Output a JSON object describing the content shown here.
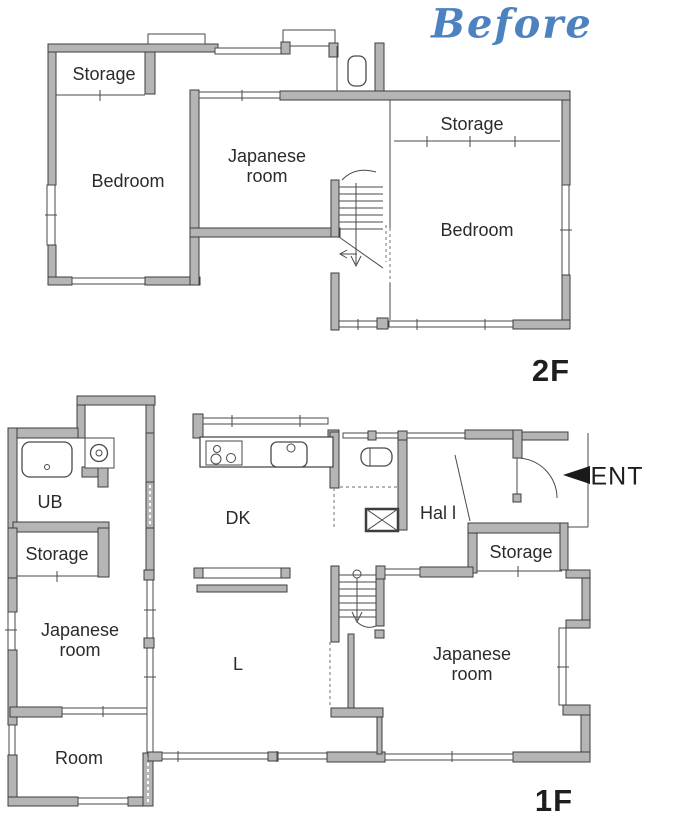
{
  "title": "Before",
  "colors": {
    "accent_blue": "#4d82c0",
    "wall_fill": "#b5b5b5",
    "wall_stroke": "#3d3d3d",
    "label_color": "#2b2b2b",
    "ent_arrow": "#1a1a1a"
  },
  "floor_2f": {
    "floor_label": "2F",
    "rooms": {
      "storage_left": "Storage",
      "bedroom_left": "Bedroom",
      "japanese_room": "Japanese room",
      "storage_right": "Storage",
      "bedroom_right": "Bedroom"
    }
  },
  "floor_1f": {
    "floor_label": "1F",
    "rooms": {
      "ub": "UB",
      "storage_left": "Storage",
      "japanese_room_left": "Japanese room",
      "room": "Room",
      "dk": "DK",
      "living": "L",
      "hall": "Hal l",
      "entrance": "ENT",
      "storage_right": "Storage",
      "japanese_room_right": "Japanese room"
    }
  }
}
